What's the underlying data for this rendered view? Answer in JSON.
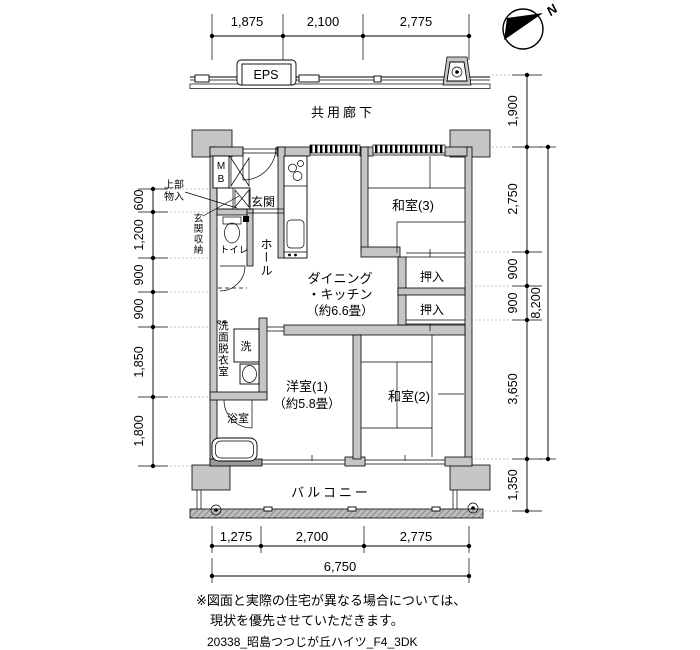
{
  "drawing": {
    "corridor_label": "共用廊下",
    "eps_label": "EPS",
    "balcony_label": "バルコニー",
    "north_label": "N",
    "note_line1": "※図面と実際の住宅が異なる場合については、",
    "note_line2": "現状を優先させていただきます。",
    "file_label": "20338_昭島つつじが丘ハイツ_F4_3DK"
  },
  "rooms": {
    "mb_top": "M",
    "mb_bottom": "B",
    "upper_storage_l1": "上部",
    "upper_storage_l2": "物入",
    "entrance_storage": "玄関収納",
    "entrance": "玄関",
    "toilet": "トイレ",
    "hall": "ホール",
    "dk_l1": "ダイニング",
    "dk_l2": "・キッチン",
    "dk_l3": "（約6.6畳）",
    "washroom": "洗面脱衣室",
    "washer": "洗",
    "bath": "浴室",
    "western1_l1": "洋室(1)",
    "western1_l2": "（約5.8畳）",
    "japanese2": "和室(2)",
    "japanese3": "和室(3)",
    "closet_upper": "押入",
    "closet_lower": "押入"
  },
  "dimensions": {
    "top": [
      "1,875",
      "2,100",
      "2,775"
    ],
    "bottom": [
      "1,275",
      "2,700",
      "2,775"
    ],
    "bottom_total": "6,750",
    "left": [
      "600",
      "1,200",
      "900",
      "900",
      "1,850",
      "1,800"
    ],
    "right": [
      "1,900",
      "2,750",
      "900",
      "900",
      "3,650",
      "1,350"
    ],
    "right_total": "8,200"
  }
}
